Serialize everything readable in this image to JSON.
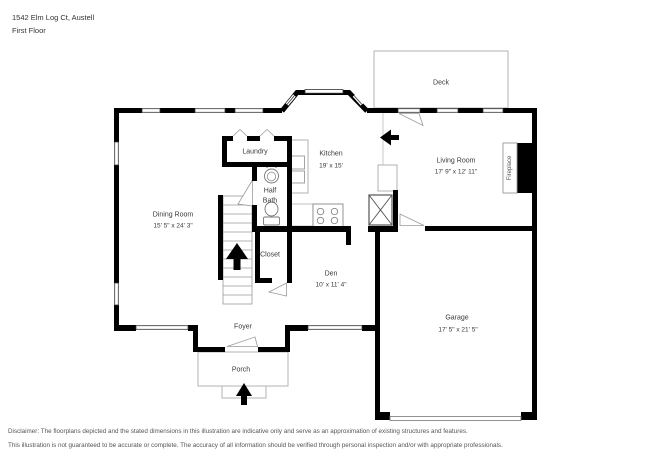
{
  "header": {
    "address": "1542 Elm Log Ct, Austell",
    "floor_label": "First Floor"
  },
  "rooms": {
    "deck": {
      "name": "Deck"
    },
    "laundry": {
      "name": "Laundry"
    },
    "kitchen": {
      "name": "Kitchen",
      "dims": "19' x 15'"
    },
    "living_room": {
      "name": "Living Room",
      "dims": "17' 9\" x 12' 11\""
    },
    "half_bath": {
      "line1": "Half",
      "line2": "Bath"
    },
    "dining_room": {
      "name": "Dining Room",
      "dims": "15' 5\" x 24' 3\""
    },
    "closet": {
      "name": "Closet"
    },
    "den": {
      "name": "Den",
      "dims": "10' x 11' 4\""
    },
    "garage": {
      "name": "Garage",
      "dims": "17' 5\" x 21' 5\""
    },
    "foyer": {
      "name": "Foyer"
    },
    "porch": {
      "name": "Porch"
    },
    "fireplace": {
      "name": "Fireplace"
    }
  },
  "colors": {
    "wall": "#000000",
    "thin_line": "#9a9a9a",
    "text": "#3a3a3a"
  },
  "footer": {
    "line1": "Disclaimer: The floorplans depicted and the stated dimensions in this illustration are indicative only and serve as an approximation of existing structures and features.",
    "line2": "This illustration is not guaranteed to be accurate or complete. The accuracy of all information should be verified through personal inspection and/or with appropriate professionals."
  }
}
